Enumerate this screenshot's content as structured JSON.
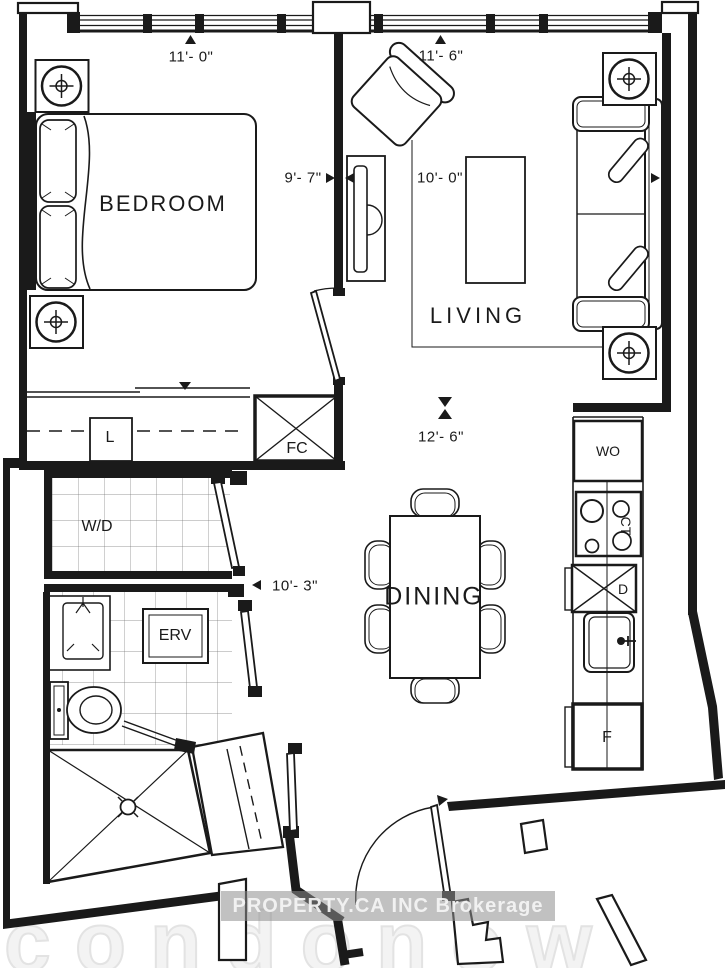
{
  "plan": {
    "line_color": "#1a1a1a",
    "tile_line_color": "#777777",
    "rooms": [
      {
        "label": "BEDROOM"
      },
      {
        "label": "LIVING"
      },
      {
        "label": "DINING"
      }
    ],
    "dims": [
      {
        "label": "11'- 0\""
      },
      {
        "label": "11'- 6\""
      },
      {
        "label": "9'- 7\""
      },
      {
        "label": "10'- 0\""
      },
      {
        "label": "12'- 6\""
      },
      {
        "label": "10'- 3\""
      }
    ],
    "fixtures": {
      "linen": "L",
      "fan_coil": "FC",
      "washer_dryer": "W/D",
      "erv": "ERV",
      "wall_oven": "WO",
      "cooktop": "CT",
      "dishwasher": "D",
      "fridge": "F"
    },
    "watermarks": {
      "brokerage": "PROPERTY.CA INC Brokerage",
      "portal": "condonow"
    }
  }
}
